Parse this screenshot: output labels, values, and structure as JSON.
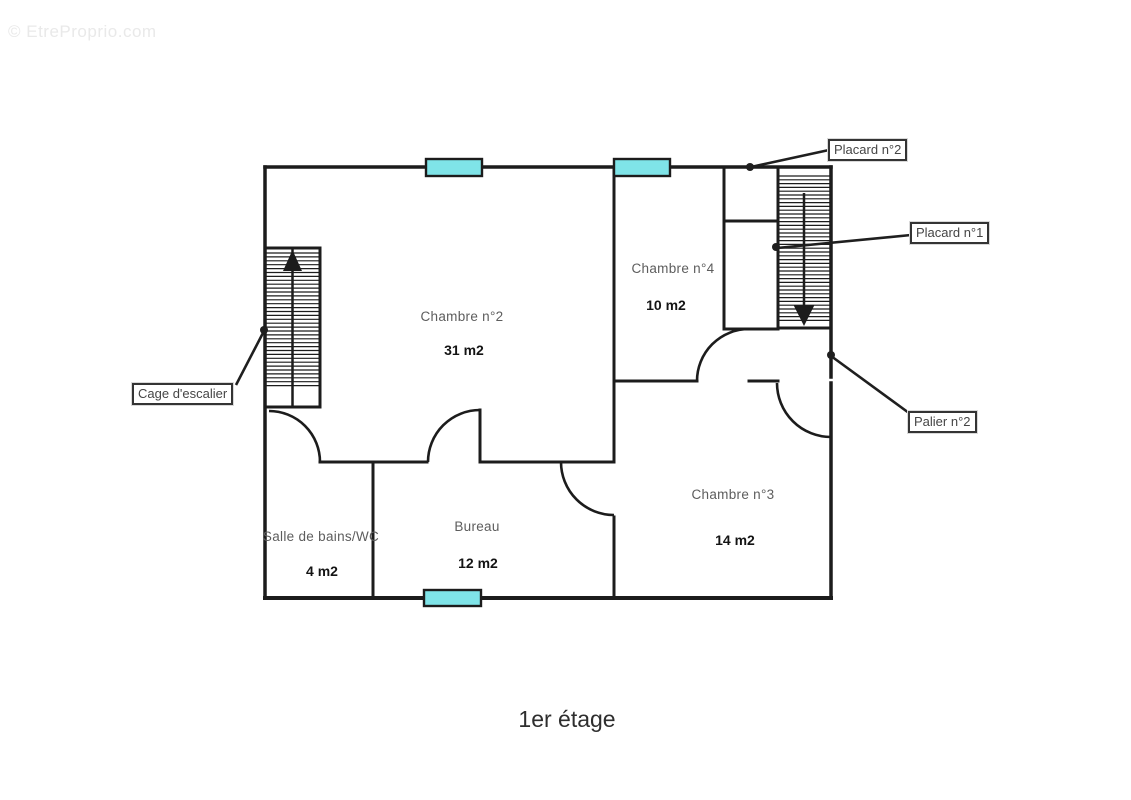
{
  "watermark": "© EtreProprio.com",
  "title": "1er étage",
  "title_pos": {
    "x": 567,
    "top": 706
  },
  "watermark_pos": {
    "x": 8,
    "top": 22
  },
  "colors": {
    "wall": "#1c1c1c",
    "window_fill": "#7fe4e8",
    "leader": "#1f1f1f",
    "room_label": "#5d5d5d",
    "area_label": "#141414",
    "callout_border": "#343434",
    "background": "#ffffff"
  },
  "rooms": [
    {
      "name": "Chambre n°2",
      "area": "31 m2",
      "name_pos": {
        "x": 462,
        "top": 309
      },
      "area_pos": {
        "x": 464,
        "top": 342
      }
    },
    {
      "name": "Chambre n°4",
      "area": "10 m2",
      "name_pos": {
        "x": 673,
        "top": 261
      },
      "area_pos": {
        "x": 666,
        "top": 297
      }
    },
    {
      "name": "Chambre n°3",
      "area": "14 m2",
      "name_pos": {
        "x": 733,
        "top": 487
      },
      "area_pos": {
        "x": 735,
        "top": 532
      }
    },
    {
      "name": "Bureau",
      "area": "12 m2",
      "name_pos": {
        "x": 477,
        "top": 519
      },
      "area_pos": {
        "x": 478,
        "top": 555
      }
    },
    {
      "name": "Salle de bains/WC",
      "area": "4 m2",
      "name_pos": {
        "x": 321,
        "top": 529
      },
      "area_pos": {
        "x": 322,
        "top": 563
      }
    }
  ],
  "callouts": [
    {
      "id": "cage-escalier",
      "label": "Cage d'escalier",
      "box": {
        "x": 132,
        "top": 383
      },
      "leader": [
        236,
        385,
        264,
        331
      ],
      "dot": [
        264,
        330
      ]
    },
    {
      "id": "placard-2",
      "label": "Placard n°2",
      "box": {
        "x": 828,
        "top": 139
      },
      "leader": [
        829,
        150,
        751,
        167
      ],
      "dot": [
        750,
        167
      ]
    },
    {
      "id": "placard-1",
      "label": "Placard n°1",
      "box": {
        "x": 910,
        "top": 222
      },
      "leader": [
        911,
        235,
        777,
        248
      ],
      "dot": [
        776,
        247
      ]
    },
    {
      "id": "palier-2",
      "label": "Palier n°2",
      "box": {
        "x": 908,
        "top": 411
      },
      "leader": [
        909,
        413,
        831,
        356
      ],
      "dot": [
        831,
        355
      ]
    }
  ],
  "plan": {
    "canvas": {
      "width": 1131,
      "height": 800
    },
    "walls": [
      {
        "name": "wall-outer-top",
        "x1": 265,
        "y1": 167,
        "x2": 831,
        "y2": 167,
        "w": 3.5
      },
      {
        "name": "wall-outer-left",
        "x1": 265,
        "y1": 167,
        "x2": 265,
        "y2": 598,
        "w": 3.5
      },
      {
        "name": "wall-outer-bottom",
        "x1": 265,
        "y1": 598,
        "x2": 831,
        "y2": 598,
        "w": 4
      },
      {
        "name": "wall-outer-right-upper",
        "x1": 831,
        "y1": 167,
        "x2": 831,
        "y2": 377,
        "w": 3.5
      },
      {
        "name": "wall-outer-right-lower",
        "x1": 831,
        "y1": 383,
        "x2": 831,
        "y2": 598,
        "w": 3.5
      },
      {
        "name": "wall-ch2-ch4-divider",
        "x1": 614,
        "y1": 167,
        "x2": 614,
        "y2": 462,
        "w": 3
      },
      {
        "name": "wall-placard-left",
        "x1": 724,
        "y1": 167,
        "x2": 724,
        "y2": 329,
        "w": 3
      },
      {
        "name": "wall-placard-divider",
        "x1": 724,
        "y1": 221,
        "x2": 778,
        "y2": 221,
        "w": 3
      },
      {
        "name": "wall-placard-bottom",
        "x1": 724,
        "y1": 329,
        "x2": 778,
        "y2": 329,
        "w": 3
      },
      {
        "name": "wall-ch4-bottom",
        "x1": 614,
        "y1": 381,
        "x2": 697,
        "y2": 381,
        "w": 3
      },
      {
        "name": "wall-ch4-bottom-stub",
        "x1": 749,
        "y1": 381,
        "x2": 778,
        "y2": 381,
        "w": 3
      },
      {
        "name": "wall-ch2-bottom-left",
        "x1": 320,
        "y1": 462,
        "x2": 427,
        "y2": 462,
        "w": 3
      },
      {
        "name": "wall-ch2-bottom-right",
        "x1": 480,
        "y1": 462,
        "x2": 614,
        "y2": 462,
        "w": 3
      },
      {
        "name": "wall-bureau-door-jamb",
        "x1": 480,
        "y1": 410,
        "x2": 480,
        "y2": 462,
        "w": 3
      },
      {
        "name": "wall-bath-bureau-divider",
        "x1": 373,
        "y1": 462,
        "x2": 373,
        "y2": 598,
        "w": 3
      },
      {
        "name": "wall-bureau-ch3-divider",
        "x1": 614,
        "y1": 517,
        "x2": 614,
        "y2": 598,
        "w": 3
      }
    ],
    "windows": [
      {
        "name": "window-top-left",
        "x": 426,
        "y": 159,
        "w": 56,
        "h": 17
      },
      {
        "name": "window-top-right",
        "x": 614,
        "y": 159,
        "w": 56,
        "h": 17
      },
      {
        "name": "window-bottom",
        "x": 424,
        "y": 590,
        "w": 57,
        "h": 16
      }
    ],
    "doors": [
      {
        "name": "door-arc-salle-de-bains",
        "r": 51,
        "x1": 269,
        "y1": 411,
        "x2": 320,
        "y2": 462,
        "sweep": 1
      },
      {
        "name": "door-arc-bureau-ch2",
        "r": 52,
        "x1": 428,
        "y1": 462,
        "x2": 480,
        "y2": 410,
        "sweep": 1
      },
      {
        "name": "door-arc-bureau-ch3",
        "r": 53,
        "x1": 561,
        "y1": 462,
        "x2": 614,
        "y2": 515,
        "sweep": 0
      },
      {
        "name": "door-arc-chambre4",
        "r": 52,
        "x1": 697,
        "y1": 381,
        "x2": 749,
        "y2": 329,
        "sweep": 1
      },
      {
        "name": "door-arc-palier-ch3",
        "r": 54,
        "x1": 777,
        "y1": 383,
        "x2": 831,
        "y2": 437,
        "sweep": 0
      }
    ],
    "stairs": [
      {
        "name": "staircase-up",
        "rect": {
          "x": 265,
          "y": 248,
          "w": 55,
          "h": 159
        },
        "border_w": 3,
        "divider_x": 292.5,
        "hatch": {
          "y0": 253,
          "y1": 389,
          "step": 3.9,
          "x0": 266.5,
          "x1": 318.5
        },
        "arrow": {
          "shaft": null,
          "head": [
            [
              292.5,
              250
            ],
            [
              283,
              271
            ],
            [
              302,
              271
            ]
          ]
        }
      },
      {
        "name": "staircase-down",
        "rect": {
          "x": 778,
          "y": 167,
          "w": 53,
          "h": 161
        },
        "border_w": 3,
        "divider_x": null,
        "hatch": {
          "y0": 176,
          "y1": 324,
          "step": 3.8,
          "x0": 779.5,
          "x1": 829.5
        },
        "arrow": {
          "shaft": [
            804,
            193,
            804,
            307
          ],
          "head": [
            [
              804,
              326
            ],
            [
              793.5,
              305
            ],
            [
              814.5,
              305
            ]
          ]
        }
      }
    ],
    "dot_radius": 4
  }
}
